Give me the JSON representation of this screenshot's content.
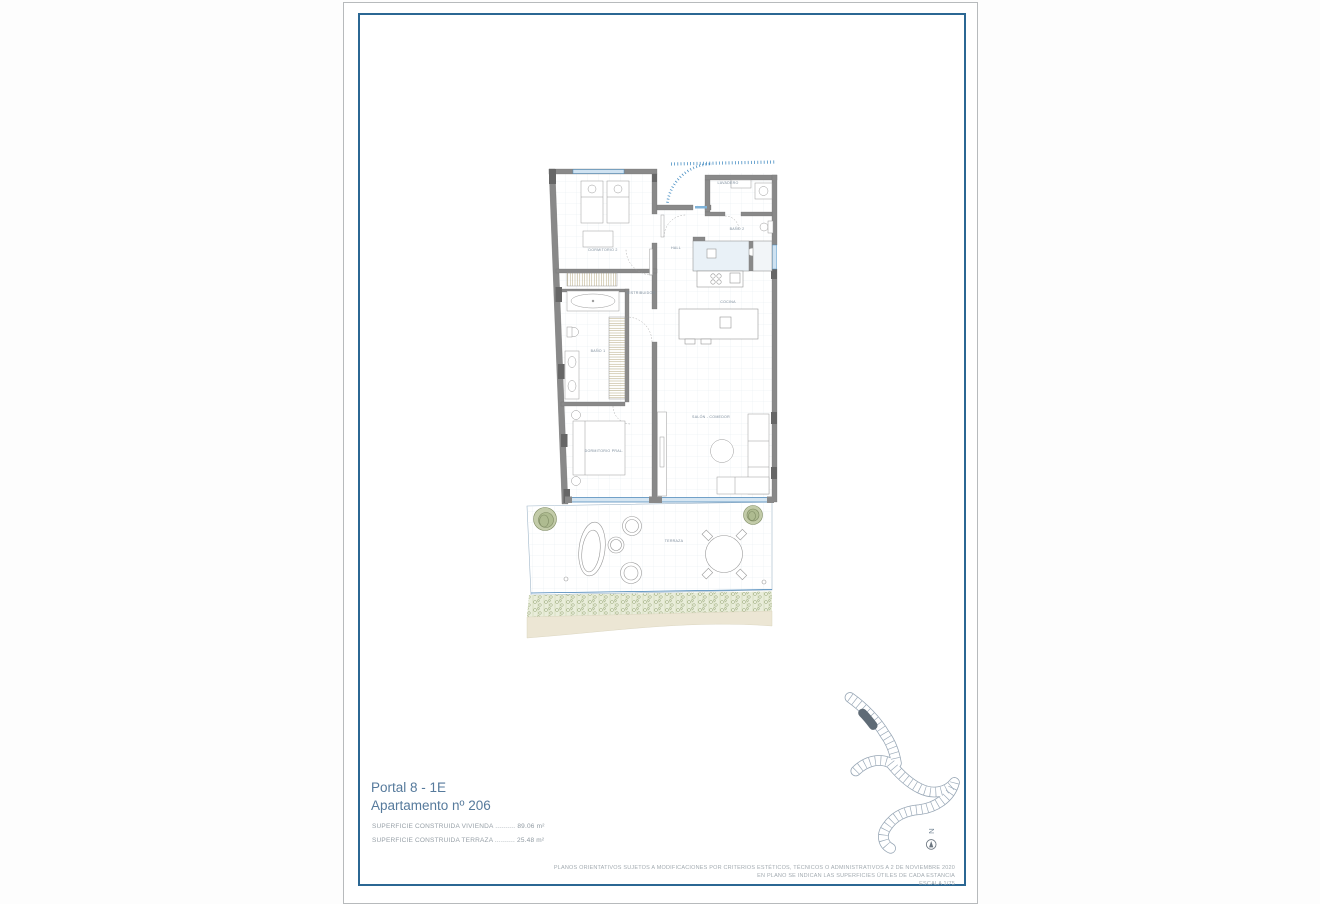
{
  "document": {
    "project_title": "Portal 8 - 1E",
    "apartment_title": "Apartamento nº 206",
    "surface_rows": [
      {
        "label": "SUPERFICIE CONSTRUIDA VIVIENDA",
        "leader": "..........",
        "value": "89.06 m²"
      },
      {
        "label": "SUPERFICIE CONSTRUIDA TERRAZA",
        "leader": "..........",
        "value": "25.48 m²"
      }
    ],
    "disclaimer_lines": [
      "PLANOS ORIENTATIVOS SUJETOS A MODIFICACIONES POR CRITERIOS ESTÉTICOS, TÉCNICOS O ADMINISTRATIVOS A 2 DE NOVIEMBRE 2020",
      "EN PLANO SE INDICAN LAS SUPERFICIES ÚTILES DE CADA ESTANCIA",
      "ESCALA 1/75"
    ],
    "compass": "N"
  },
  "floorplan": {
    "rooms": [
      "DORMITORIO 2",
      "HALL",
      "LAVADERO",
      "BAÑO 2",
      "COCINA",
      "DISTRIBUIDOR",
      "BAÑO 1",
      "DORMITORIO PRAL.",
      "SALÓN - COMEDOR",
      "TERRAZA"
    ]
  },
  "colors": {
    "frame_blue": "#2b6793",
    "accent_blue": "#4a90c4",
    "glass_blue": "#cfe2f1",
    "title_blue": "#567a9c",
    "wall_gray": "#898989",
    "plant_green": "#aebb90",
    "bush_green": "#93a273",
    "sand_beige": "#ece6d4"
  }
}
